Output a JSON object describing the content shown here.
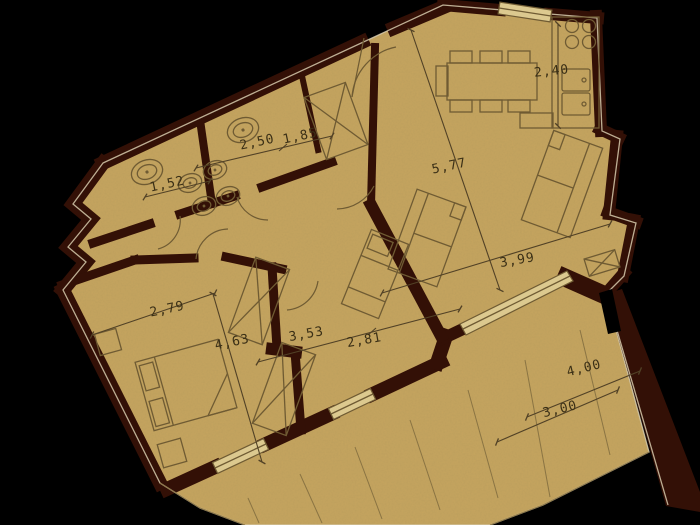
{
  "title": "apartment-floor-plan",
  "palette": {
    "background": "#000000",
    "floor": "#c6a55f",
    "wall": "#331006",
    "furniture_line": "#6f5b33",
    "dimension_text": "#3a2f16",
    "window_fill": "#dcc98f",
    "outer_outline": "#d7cbae"
  },
  "dimensions": {
    "kitchen_depth": {
      "label": "2,40",
      "meters": 2.4
    },
    "living_length": {
      "label": "5,77",
      "meters": 5.77
    },
    "living_width": {
      "label": "3,99",
      "meters": 3.99
    },
    "bath_main": {
      "label": "2,50",
      "meters": 2.5
    },
    "entry_closet": {
      "label": "1,85",
      "meters": 1.85
    },
    "bath_small": {
      "label": "1,52",
      "meters": 1.52
    },
    "bedroom1_width": {
      "label": "2,79",
      "meters": 2.79
    },
    "bedroom1_length": {
      "label": "4,63",
      "meters": 4.63
    },
    "corridor_length": {
      "label": "3,53",
      "meters": 3.53
    },
    "bedroom2_width": {
      "label": "2,81",
      "meters": 2.81
    },
    "terrace_length": {
      "label": "4,00",
      "meters": 4.0
    },
    "terrace_width": {
      "label": "3,00",
      "meters": 3.0
    }
  }
}
